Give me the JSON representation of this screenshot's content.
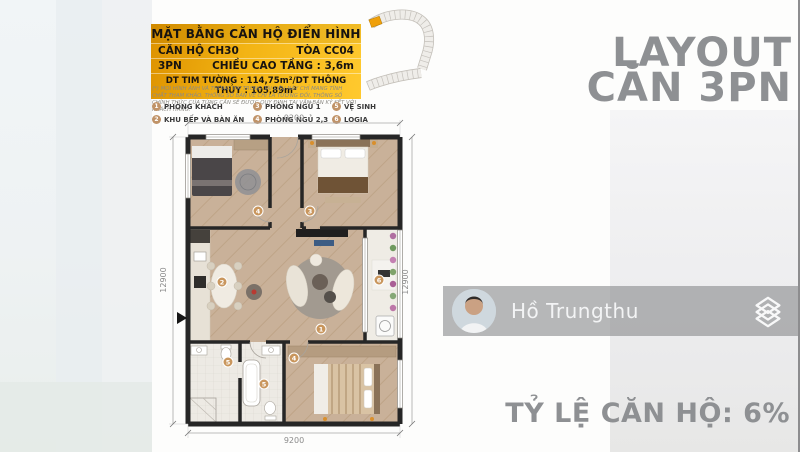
{
  "info_card": {
    "title": "MẶT BẰNG CĂN HỘ ĐIỂN HÌNH",
    "row1_left": "CĂN HỘ CH30",
    "row1_right": "TÒA CC04",
    "row2_left": "3PN",
    "row2_right": "CHIỀU CAO TẦNG : 3,6m",
    "area_line": "DT TIM TƯỜNG : 114,75m²/DT THÔNG THỦY : 105,89m²",
    "accent_dark": "#dd9200",
    "accent_light": "#ffc92e"
  },
  "disclaimer": "(*) MỌI HÌNH ẢNH VÀ THÔNG TIN TRONG TÀI LIỆU NÀY CHỈ MANG TÍNH CHẤT THAM KHẢO. THÔNG SỐ BẢN VẼ CHỈ LÀ TƯƠNG ĐỐI, THÔNG SỐ CHÍNH THỨC CỦA TỪNG CĂN SẼ ĐƯỢC QUY ĐỊNH TẠI VĂN BẢN KÝ KẾT VỚI KHÁCH HÀNG.",
  "legend": {
    "badge_color": "#c09368",
    "items": [
      {
        "num": "1",
        "label": "PHÒNG KHÁCH"
      },
      {
        "num": "3",
        "label": "PHÒNG NGỦ 1"
      },
      {
        "num": "5",
        "label": "VỆ SINH"
      },
      {
        "num": "2",
        "label": "KHU BẾP VÀ BÀN ĂN"
      },
      {
        "num": "4",
        "label": "PHÒNG NGỦ 2,3"
      },
      {
        "num": "6",
        "label": "LOGIA"
      }
    ]
  },
  "plan": {
    "dim_top": "9200",
    "dim_bottom": "9200",
    "dim_left": "12900",
    "dim_right": "12900",
    "marker_color": "#c9965d",
    "markers": [
      {
        "n": "1"
      },
      {
        "n": "2"
      },
      {
        "n": "3"
      },
      {
        "n": "4"
      },
      {
        "n": "4"
      },
      {
        "n": "5"
      },
      {
        "n": "5"
      },
      {
        "n": "6"
      }
    ]
  },
  "headline": {
    "line1": "LAYOUT",
    "line2": "CĂN 3PN",
    "color": "#8e9093"
  },
  "agent": {
    "name": "Hồ Trungthu"
  },
  "footer": {
    "ratio_text": "TỶ LỆ CĂN HỘ: 6%"
  }
}
